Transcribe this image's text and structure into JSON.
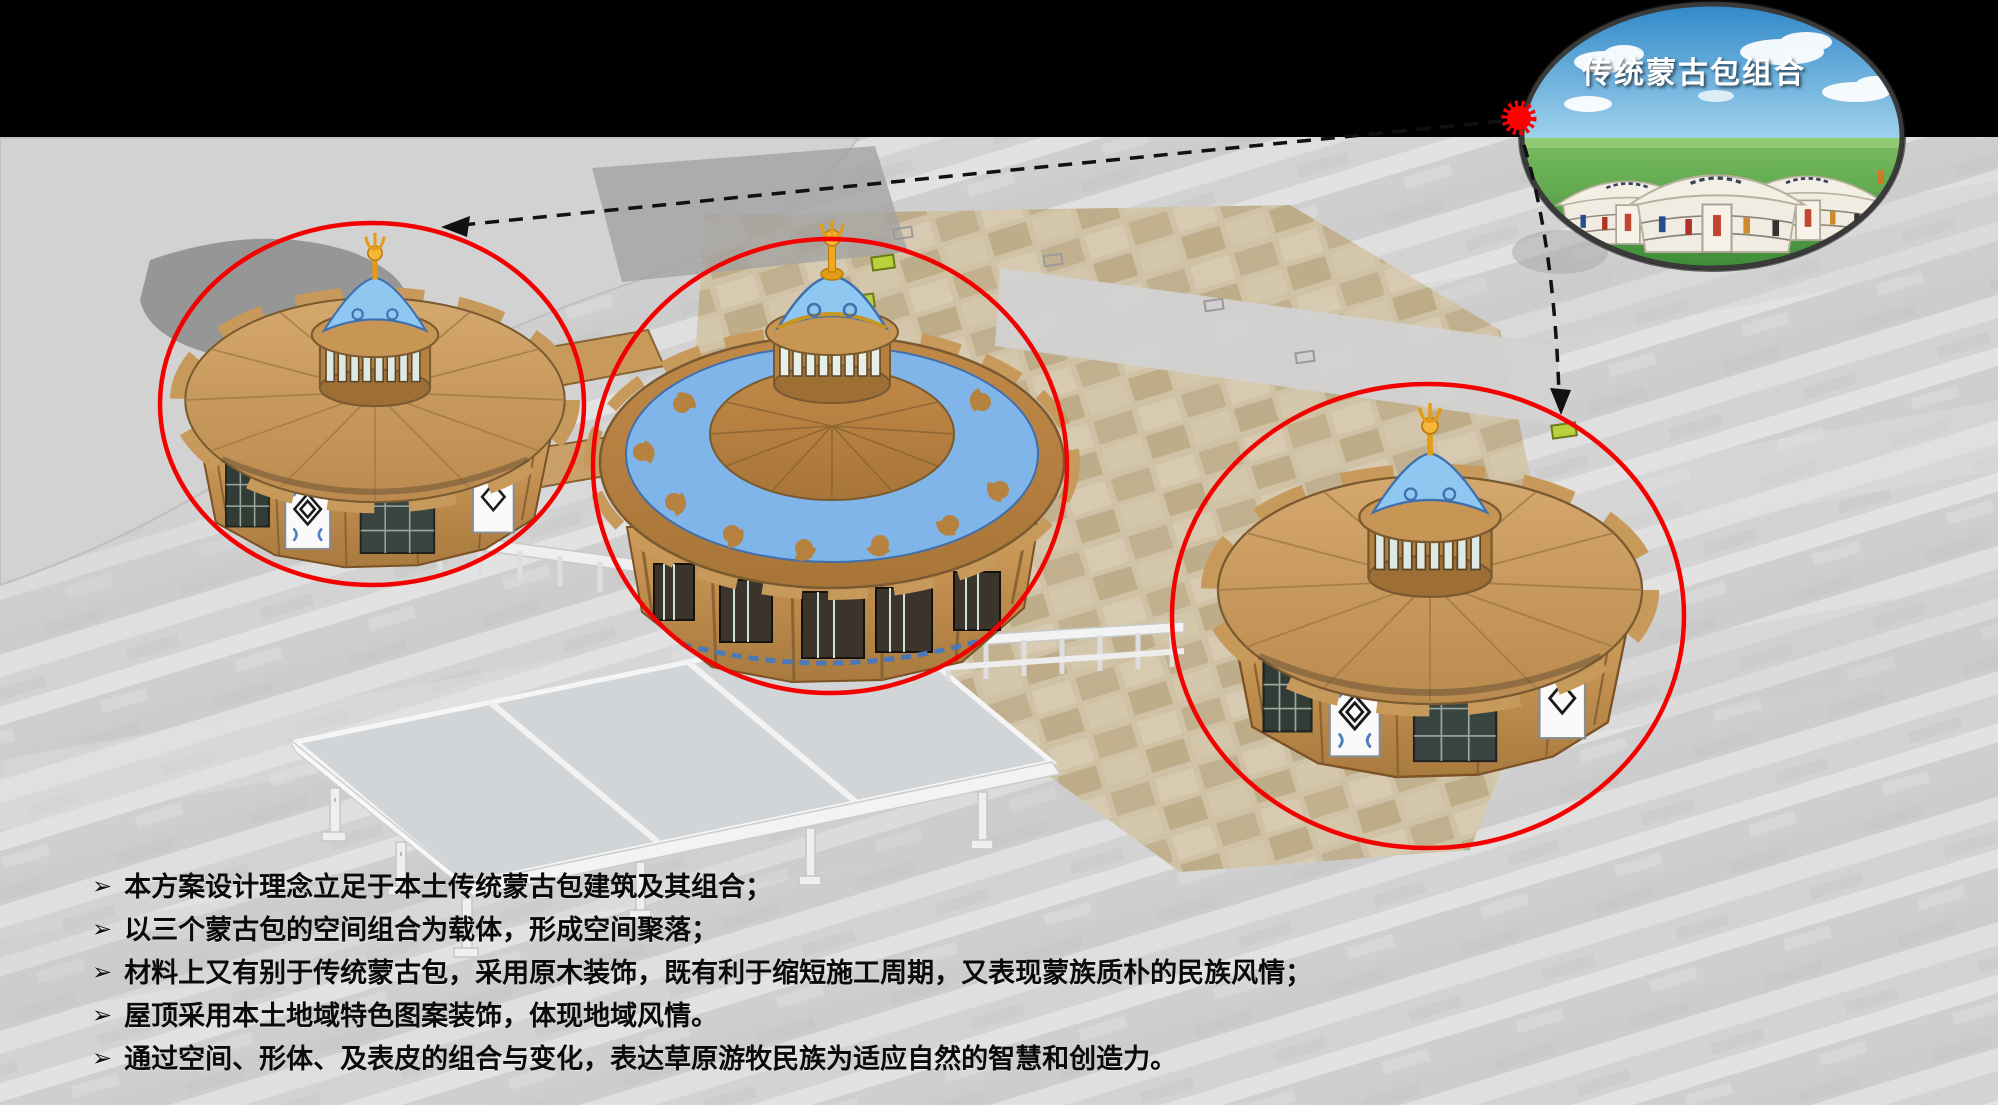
{
  "inset": {
    "label": "传统蒙古包组合"
  },
  "notes": {
    "bullet_glyph": "➢",
    "items": [
      {
        "text": "本方案设计理念立足于本土传统蒙古包建筑及其组合；"
      },
      {
        "text": "以三个蒙古包的空间组合为载体，形成空间聚落；"
      },
      {
        "text": "材料上又有别于传统蒙古包，采用原木装饰，既有利于缩短施工周期，又表现蒙族质朴的民族风情；"
      },
      {
        "text": "屋顶采用本土地域特色图案装饰，体现地域风情。"
      },
      {
        "text": "通过空间、形体、及表皮的组合与变化，表达草原游牧民族为适应自然的智慧和创造力。"
      }
    ]
  },
  "colors": {
    "highlight_red": "#ff0000",
    "roof_tan": "#c99a5f",
    "dome_brown": "#b5813f",
    "pattern_blue": "#7fb5e8",
    "finial_gold": "#f2a81d",
    "plaza_gray": "#d8d8d8",
    "plaza_beige": "#cfc1a3",
    "band_black": "#000000",
    "inset_sky_blue": "#2e86c8",
    "inset_grass_green": "#55a344"
  }
}
